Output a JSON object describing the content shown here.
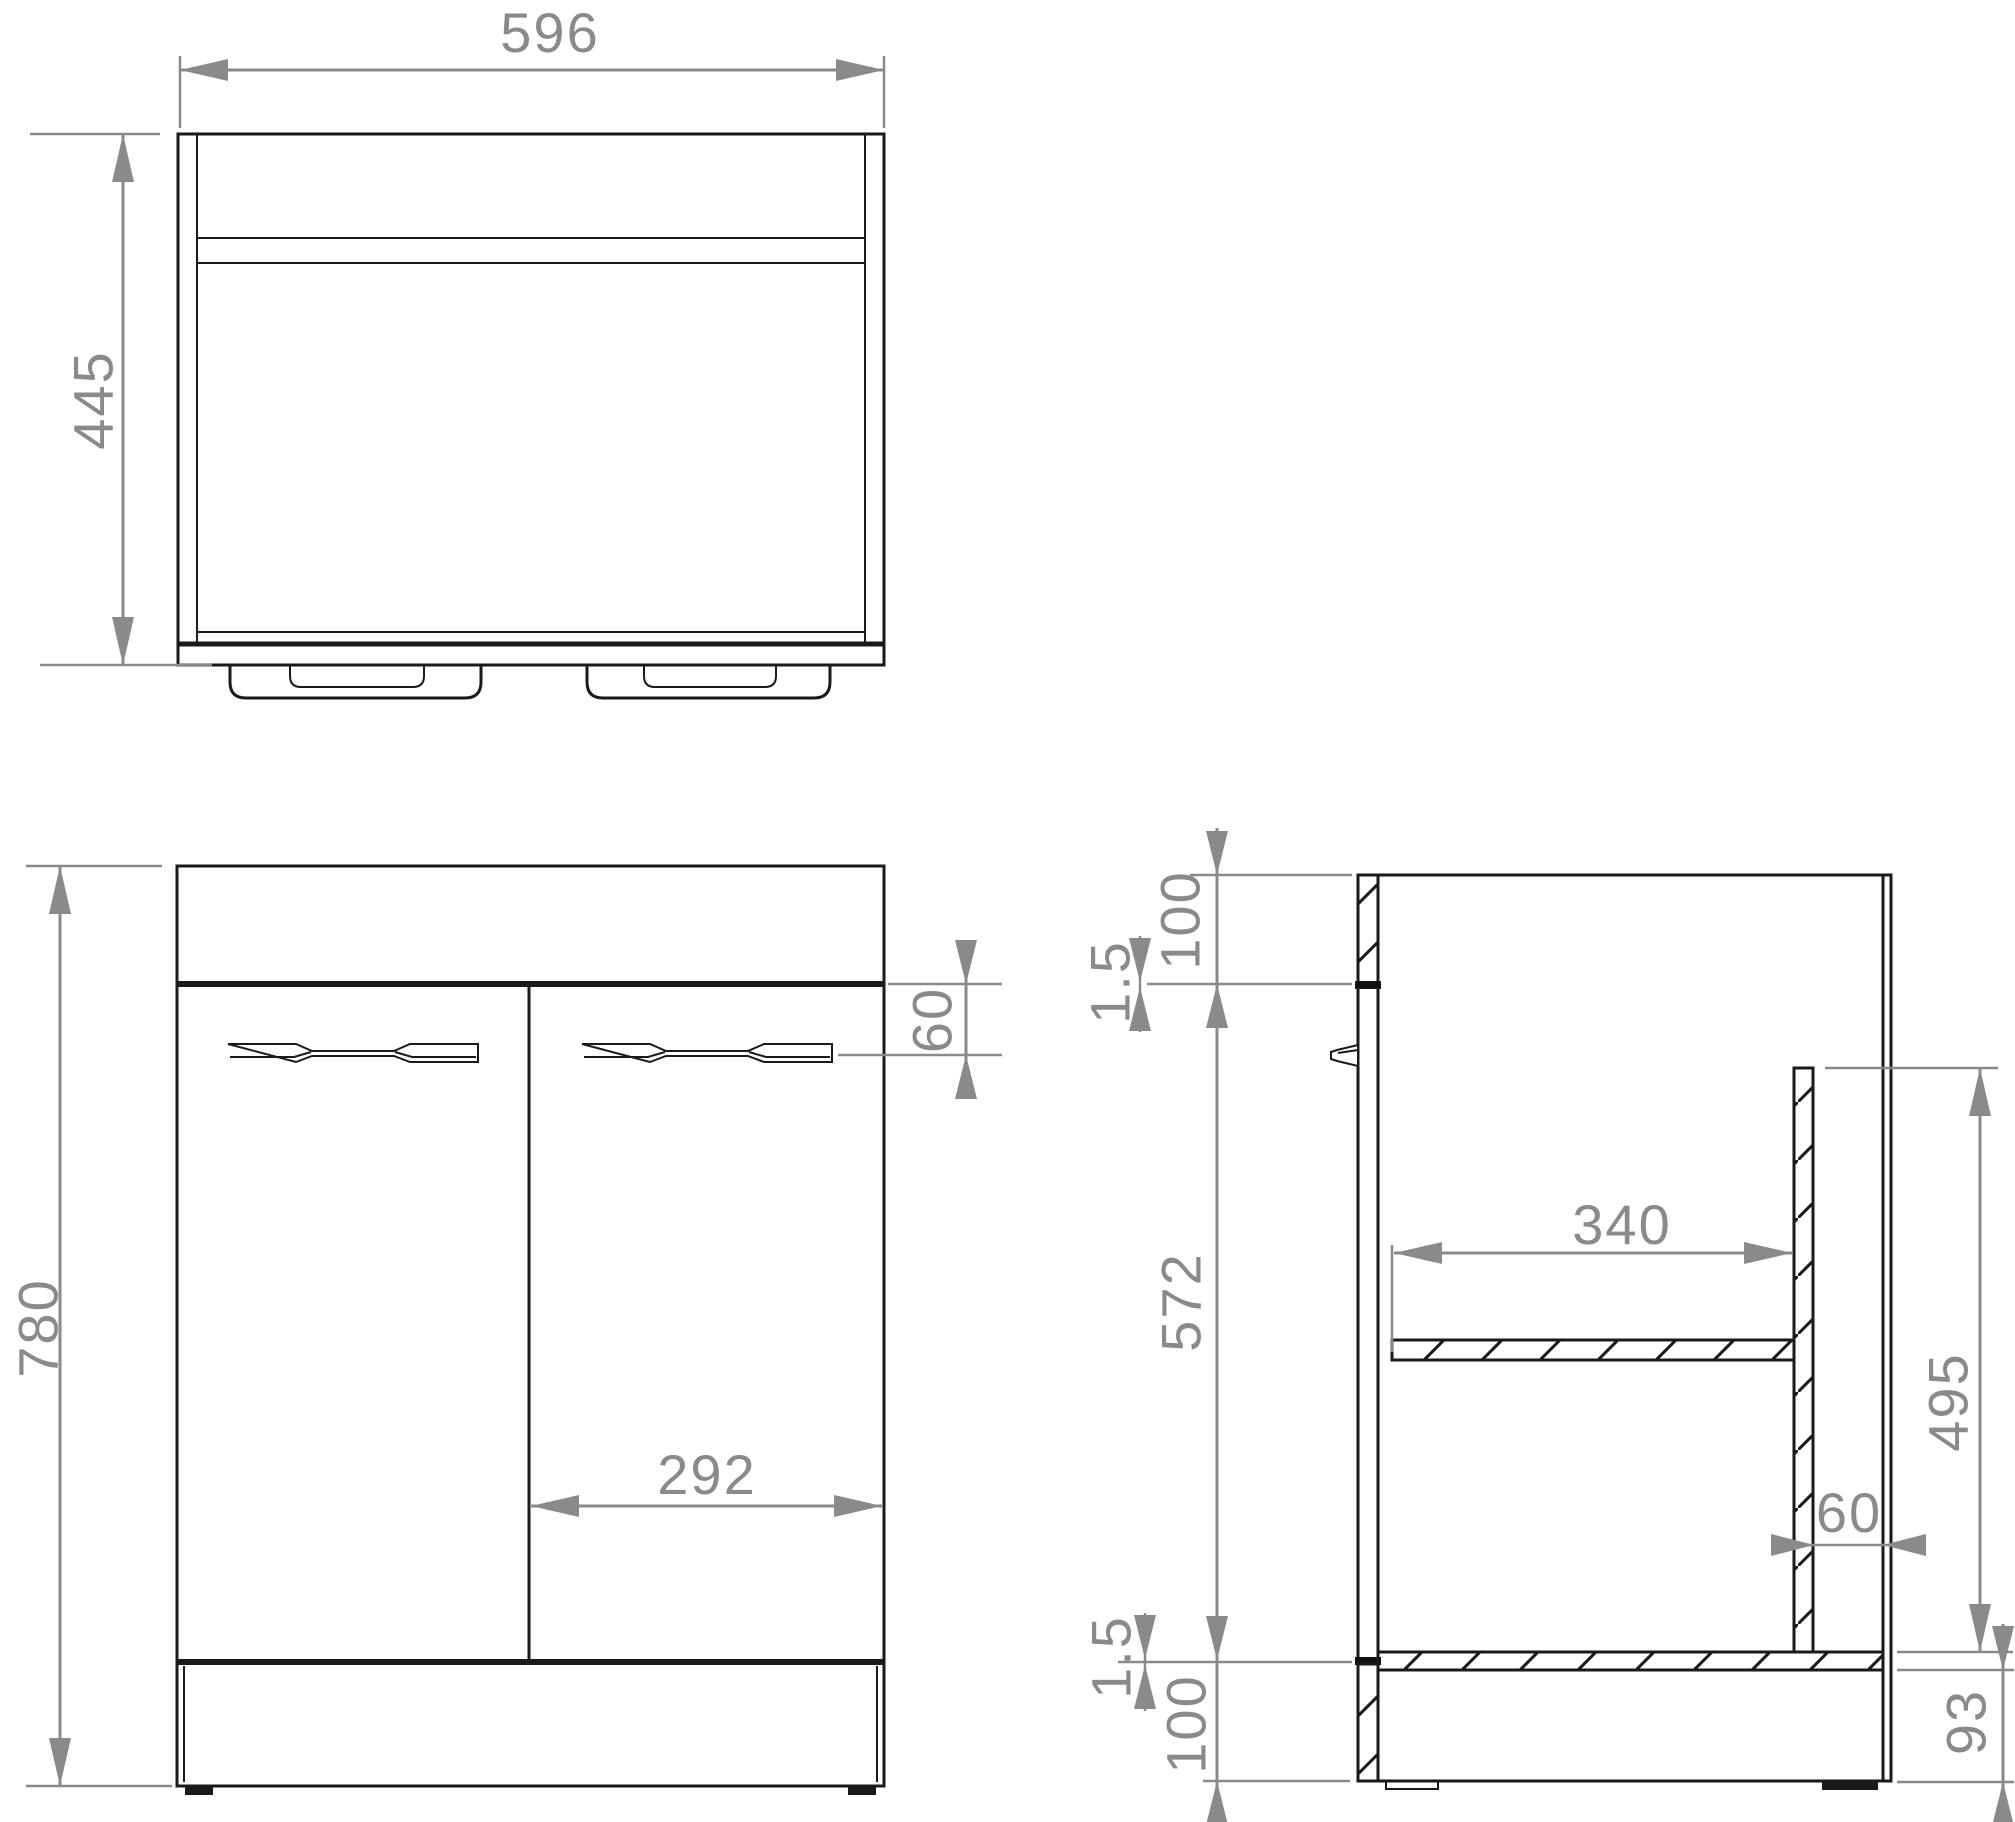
{
  "drawing": {
    "type": "dimensioned technical drawing",
    "subject": "two-door vanity sink base cabinet - orthographic views (plan, front, side section)",
    "units": "mm",
    "colors": {
      "line": "#1a1a1a",
      "dimension": "#8a8a8a",
      "background": "#ffffff"
    }
  },
  "dims": {
    "plan": {
      "width": "596",
      "depth": "445"
    },
    "front": {
      "height": "780",
      "right_door_width": "292",
      "handle_offset_from_door_top": "60"
    },
    "side": {
      "top_band_height": "100",
      "top_door_gap": "1.5",
      "door_height": "572",
      "shelf_depth": "340",
      "partition_height": "495",
      "back_service_gap": "60",
      "bottom_door_gap": "1.5",
      "plinth_height": "100",
      "plinth_recess_height": "93"
    }
  }
}
